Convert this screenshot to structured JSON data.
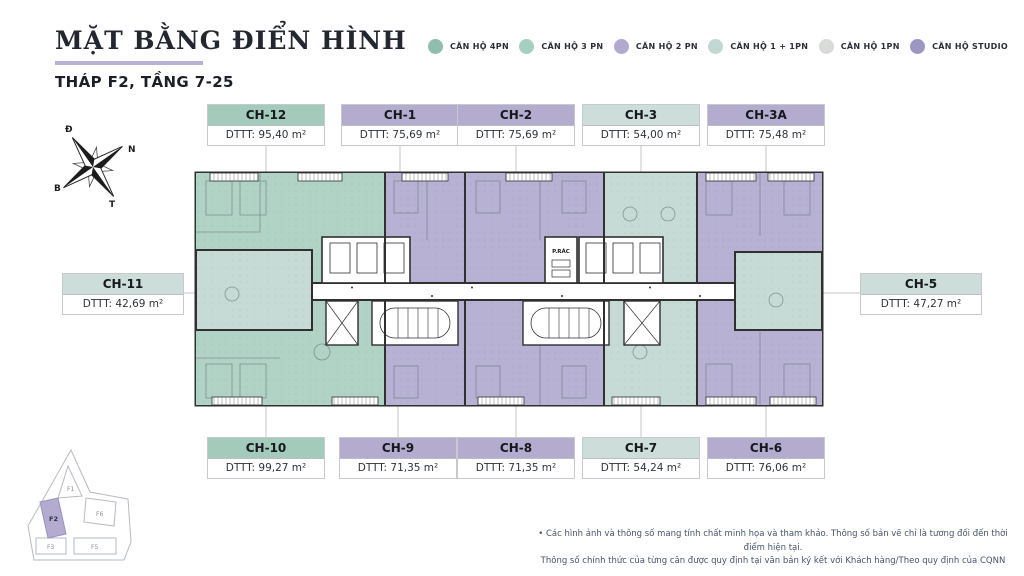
{
  "header": {
    "title": "MẶT BẰNG ĐIỂN HÌNH",
    "subtitle": "THÁP F2, TẦNG 7-25"
  },
  "legend": {
    "items": [
      {
        "label": "CĂN HỘ 4PN",
        "color": "#8ebfae"
      },
      {
        "label": "CĂN HỘ 3 PN",
        "color": "#a7cfc0"
      },
      {
        "label": "CĂN HỘ 2 PN",
        "color": "#b1a9ce"
      },
      {
        "label": "CĂN HỘ 1 + 1PN",
        "color": "#c2d7d2"
      },
      {
        "label": "CĂN HỘ 1PN",
        "color": "#d8dbd8"
      },
      {
        "label": "CĂN HỘ STUDIO",
        "color": "#9c96c2"
      }
    ]
  },
  "compass": {
    "east": "Đ",
    "south": "N",
    "north": "B",
    "west": "T"
  },
  "units": [
    {
      "code": "CH-12",
      "area": "DTTT: 95,40 m²",
      "type": "4PN",
      "header_color": "#a4cabb"
    },
    {
      "code": "CH-1",
      "area": "DTTT: 75,69 m²",
      "type": "2PN",
      "header_color": "#b3accf"
    },
    {
      "code": "CH-2",
      "area": "DTTT: 75,69 m²",
      "type": "2PN",
      "header_color": "#b3accf"
    },
    {
      "code": "CH-3",
      "area": "DTTT: 54,00 m²",
      "type": "1+1PN",
      "header_color": "#cdddd9"
    },
    {
      "code": "CH-3A",
      "area": "DTTT: 75,48 m²",
      "type": "2PN",
      "header_color": "#b3accf"
    },
    {
      "code": "CH-11",
      "area": "DTTT: 42,69 m²",
      "type": "1+1PN",
      "header_color": "#cdddd9"
    },
    {
      "code": "CH-5",
      "area": "DTTT: 47,27 m²",
      "type": "1+1PN",
      "header_color": "#cdddd9"
    },
    {
      "code": "CH-10",
      "area": "DTTT: 99,27 m²",
      "type": "4PN",
      "header_color": "#a4cabb"
    },
    {
      "code": "CH-9",
      "area": "DTTT: 71,35 m²",
      "type": "2PN",
      "header_color": "#b3accf"
    },
    {
      "code": "CH-8",
      "area": "DTTT: 71,35 m²",
      "type": "2PN",
      "header_color": "#b3accf"
    },
    {
      "code": "CH-7",
      "area": "DTTT: 54,24 m²",
      "type": "1+1PN",
      "header_color": "#cdddd9"
    },
    {
      "code": "CH-6",
      "area": "DTTT: 76,06 m²",
      "type": "2PN",
      "header_color": "#b3accf"
    }
  ],
  "core": {
    "trash_room_label": "P.RÁC"
  },
  "site_plan": {
    "buildings": [
      {
        "label": "F1"
      },
      {
        "label": "F2"
      },
      {
        "label": "F6"
      },
      {
        "label": "F3"
      },
      {
        "label": "F5"
      }
    ],
    "highlighted": "F2",
    "highlight_color": "#b3abd0"
  },
  "footer": {
    "line1": "•  Các hình ảnh và thông số mang tính chất minh họa và tham khảo. Thông số bản vẽ chỉ là tương đối đến thời điểm hiện tại.",
    "line2": "Thông số chính thức của từng căn được quy định tại văn bản ký kết với Khách hàng/Theo quy định của CQNN"
  },
  "colors": {
    "unit_4pn": "#b0d3c6",
    "unit_2pn": "#b7b1d3",
    "unit_1p1pn": "#c7dbd6",
    "wall": "#303030",
    "leader": "#c3c7cb",
    "accent_underline": "#b8b1d6"
  }
}
